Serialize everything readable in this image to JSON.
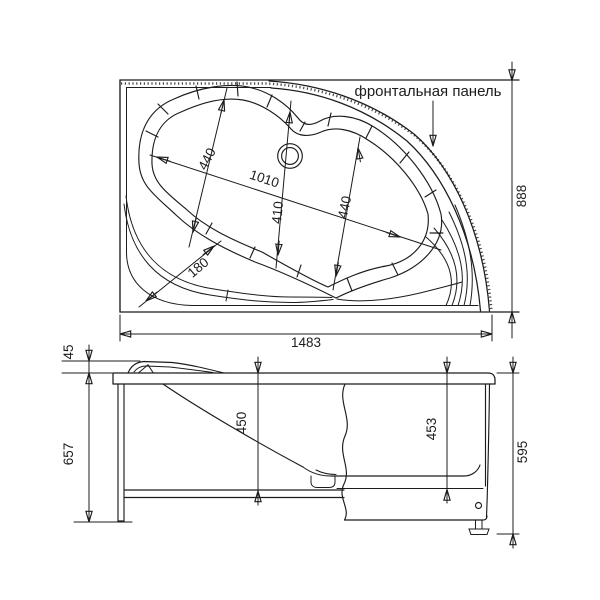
{
  "drawing": {
    "frontal_panel_label": "фронтальная панель",
    "top_view": {
      "overall_width": "1483",
      "overall_depth": "888",
      "bowl_length": "1010",
      "bowl_width_head": "440",
      "bowl_width_middle": "410",
      "bowl_width_foot": "440",
      "seat_width": "180"
    },
    "side_view": {
      "headrest_height": "45",
      "frame_height": "657",
      "inner_depth": "450",
      "panel_height": "453",
      "overall_height_with_panel": "595"
    },
    "colors": {
      "line": "#1c1c1c",
      "background": "#ffffff",
      "panel_edge_dots": "#4b4b4b"
    }
  }
}
